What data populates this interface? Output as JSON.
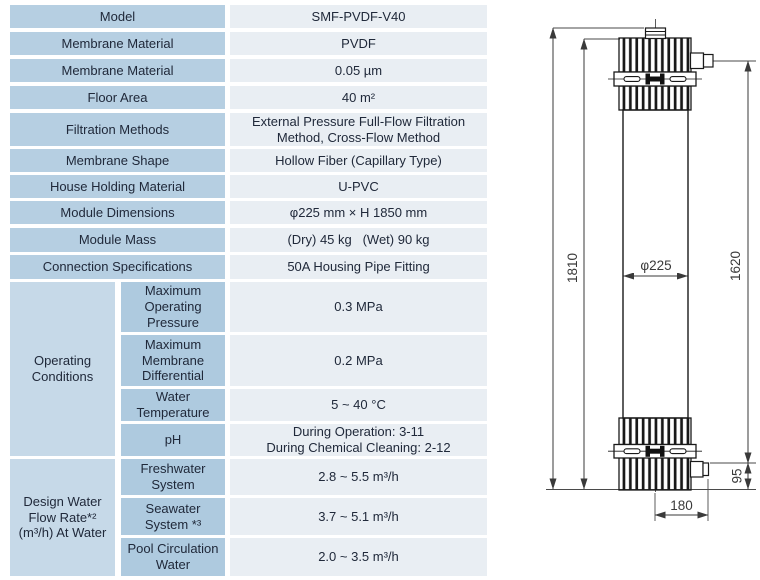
{
  "table": {
    "rows": [
      {
        "label": "Model",
        "value": "SMF-PVDF-V40"
      },
      {
        "label": "Membrane Material",
        "value": "PVDF"
      },
      {
        "label": "Membrane Material",
        "value": "0.05 µm"
      },
      {
        "label": "Floor Area",
        "value": "40 m²"
      },
      {
        "label": "Filtration Methods",
        "value": "External Pressure Full-Flow Filtration Method, Cross-Flow Method"
      },
      {
        "label": "Membrane Shape",
        "value": "Hollow Fiber (Capillary Type)"
      },
      {
        "label": "House Holding Material",
        "value": "U-PVC"
      },
      {
        "label": "Module Dimensions",
        "value": "φ225 mm × H 1850 mm"
      },
      {
        "label": "Module Mass",
        "value": "(Dry) 45 kg   (Wet) 90 kg"
      },
      {
        "label": "Connection Specifications",
        "value": "50A Housing Pipe Fitting"
      }
    ],
    "groups": [
      {
        "label": "Operating Conditions",
        "rows": [
          {
            "label": "Maximum Operating Pressure",
            "value": "0.3 MPa"
          },
          {
            "label": "Maximum Membrane Differential",
            "value": "0.2 MPa"
          },
          {
            "label": "Water Temperature",
            "value": "5 ~ 40 °C"
          },
          {
            "label": "pH",
            "value": "During Operation: 3-11\nDuring Chemical Cleaning: 2-12"
          }
        ]
      },
      {
        "label": "Design Water Flow Rate*² (m³/h) At Water",
        "rows": [
          {
            "label": "Freshwater System",
            "value": "2.8 ~ 5.5 m³/h"
          },
          {
            "label": "Seawater System *³",
            "value": "3.7 ~ 5.1 m³/h"
          },
          {
            "label": "Pool Circulation Water",
            "value": "2.0 ~ 3.5 m³/h"
          }
        ]
      }
    ]
  },
  "diagram": {
    "dim_overall": "1810",
    "dim_port_span": "1620",
    "dim_diameter": "φ225",
    "dim_bottom_offset": "95",
    "dim_port_offset": "180"
  },
  "colors": {
    "label_cell": "#b6cfe2",
    "group_cell": "#c6d9e8",
    "sub_label_cell": "#aecadf",
    "value_cell": "#e9eef3",
    "text": "#20293a",
    "drawing_line": "#1a1a1a"
  }
}
